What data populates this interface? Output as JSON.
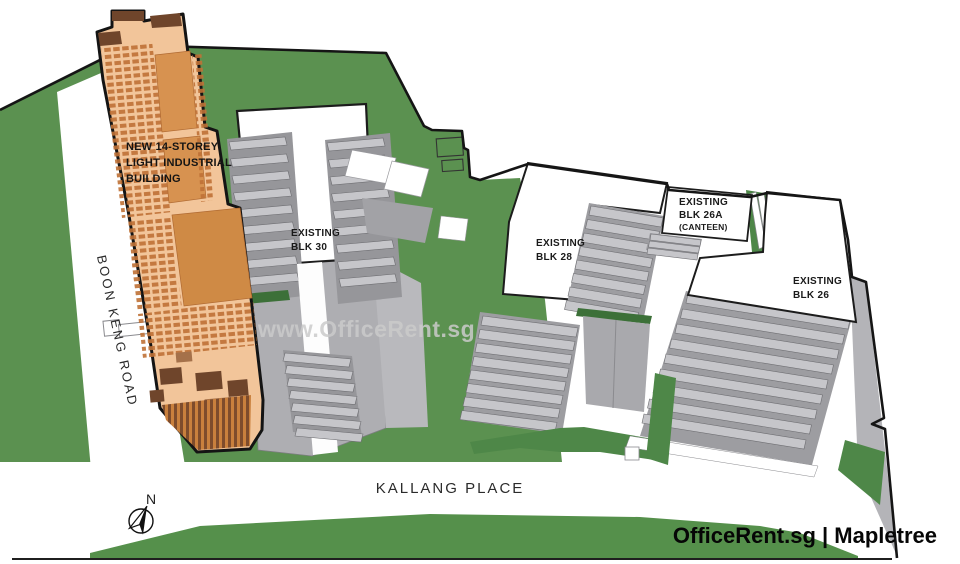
{
  "map": {
    "title": "Kallang Place industrial estate site plan",
    "buildings": {
      "new_building": {
        "label_line1": "NEW 14-STOREY",
        "label_line2": "LIGHT INDUSTRIAL",
        "label_line3": "BUILDING",
        "highlight_color": "#f2c59a"
      },
      "blk30": {
        "line1": "EXISTING",
        "line2": "BLK 30"
      },
      "blk28": {
        "line1": "EXISTING",
        "line2": "BLK 28"
      },
      "blk26a": {
        "line1": "EXISTING",
        "line2": "BLK 26A",
        "line3": "(CANTEEN)"
      },
      "blk26": {
        "line1": "EXISTING",
        "line2": "BLK 26"
      }
    },
    "roads": {
      "boon_keng": "BOON KENG ROAD",
      "kallang_place": "KALLANG PLACE"
    },
    "compass": {
      "north_label": "N"
    },
    "watermark": "www.OfficeRent.sg",
    "branding": "OfficeRent.sg | Mapletree",
    "colors": {
      "grass": "#5b9150",
      "grass_dark": "#3c7038",
      "terrace_gray": "#c6c6ca",
      "wall_gray": "#b0b0b4",
      "orange_base": "#f2c59a",
      "orange_panel": "#d79250",
      "brown_dark": "#6f452b",
      "outline": "#161616"
    }
  }
}
